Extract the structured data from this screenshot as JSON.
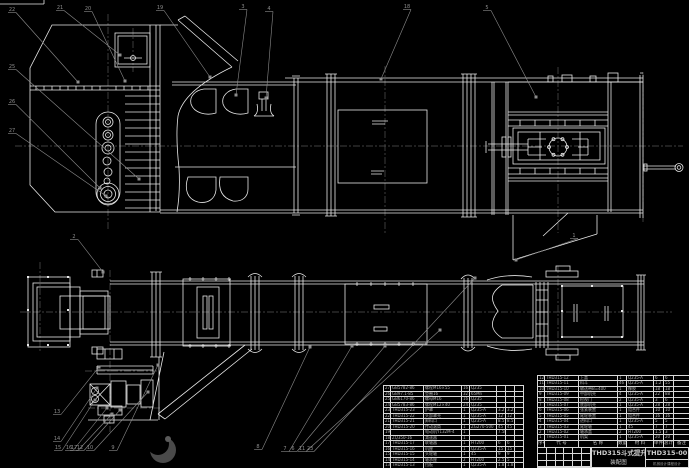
{
  "drawing": {
    "title": "THD315斗式提升机",
    "subtitle": "装配图",
    "drawing_number": "THD315-00",
    "footer_note": "机械设计课程设计",
    "views": {
      "upper_view": "侧视图 (head / casing / boot section)",
      "lower_view": "俯视图 (plan view with drive unit)"
    },
    "colors": {
      "background": "#000000",
      "line": "#e8e8e8",
      "leader": "#8c8c8c",
      "centerline": "#565656",
      "table_text": "#b0b0b0",
      "table_line": "#d9d9d9",
      "stamp": "#4a4a4a"
    }
  },
  "bom_header": [
    [
      "序号",
      "代 号",
      "名 称",
      "数量",
      "材 料",
      "单件",
      "总计",
      "备注"
    ]
  ],
  "bom_left": {
    "rows": [
      [
        "27",
        "GB5782-86",
        "螺栓M16×55",
        "16",
        "Q235",
        "",
        "",
        ""
      ],
      [
        "26",
        "GB97.1-85",
        "垫圈16",
        "32",
        "65Mn",
        "",
        "",
        ""
      ],
      [
        "25",
        "GB6170-86",
        "螺母M16",
        "16",
        "Q235",
        "",
        "",
        ""
      ],
      [
        "24",
        "GB5783-86",
        "螺栓M12×40",
        "24",
        "Q235",
        "",
        "",
        ""
      ],
      [
        "23",
        "THD315-23",
        "护罩",
        "1",
        "Q235-A",
        "3.2",
        "3.2",
        ""
      ],
      [
        "22",
        "THD315-22",
        "头部罩壳",
        "1",
        "Q235-A",
        "12",
        "12",
        ""
      ],
      [
        "21",
        "THD315-21",
        "卸料口",
        "1",
        "Q235-A",
        "8.5",
        "8.5",
        ""
      ],
      [
        "20",
        "THD315-20",
        "传动滚筒",
        "1",
        "ZG270-500",
        "45",
        "45",
        ""
      ],
      [
        "19",
        "",
        "电动机Y132M-4",
        "1",
        "",
        "7.5kW",
        "",
        ""
      ],
      [
        "18",
        "ZQ350-16",
        "减速器",
        "1",
        "",
        "",
        "",
        ""
      ],
      [
        "17",
        "THD315-17",
        "联轴器",
        "1",
        "HT200",
        "6",
        "6",
        ""
      ],
      [
        "16",
        "THD315-16",
        "机座",
        "1",
        "Q235-A",
        "15",
        "15",
        ""
      ],
      [
        "15",
        "THD315-15",
        "头轮轴",
        "1",
        "45",
        "9",
        "9",
        ""
      ],
      [
        "14",
        "THD315-14",
        "轴承座",
        "2",
        "HT200",
        "2.5",
        "5",
        ""
      ],
      [
        "13",
        "THD315-13",
        "挡板",
        "1",
        "Q235-A",
        "1.8",
        "1.8",
        ""
      ]
    ]
  },
  "bom_right": {
    "rows": [
      [
        "12",
        "THD315-12",
        "上盖",
        "1",
        "Q235-A",
        "6",
        "6",
        ""
      ],
      [
        "11",
        "THD315-11",
        "料斗",
        "46",
        "Q235-A",
        "1.2",
        "55",
        ""
      ],
      [
        "10",
        "THD315-10",
        "输送带B=400",
        "1",
        "橡胶",
        "18",
        "18",
        ""
      ],
      [
        "9",
        "THD315-09",
        "中部机壳",
        "4",
        "Q235-A",
        "22",
        "88",
        ""
      ],
      [
        "8",
        "THD315-08",
        "检视门",
        "2",
        "Q235-A",
        "3",
        "6",
        ""
      ],
      [
        "7",
        "THD315-07",
        "底部机壳",
        "1",
        "Q235-A",
        "28",
        "28",
        ""
      ],
      [
        "6",
        "THD315-06",
        "张紧装置",
        "1",
        "组合件",
        "10",
        "10",
        ""
      ],
      [
        "5",
        "THD315-05",
        "尾轮装置",
        "1",
        "组合件",
        "16",
        "16",
        ""
      ],
      [
        "4",
        "THD315-04",
        "进料口",
        "1",
        "Q235-A",
        "5",
        "5",
        ""
      ],
      [
        "3",
        "THD315-03",
        "尾轮轴",
        "1",
        "45",
        "7",
        "7",
        ""
      ],
      [
        "2",
        "THD315-02",
        "轴承盖",
        "2",
        "HT200",
        "1.5",
        "3",
        ""
      ],
      [
        "1",
        "THD315-01",
        "机架",
        "1",
        "Q235-A",
        "20",
        "20",
        ""
      ]
    ]
  },
  "balloons": {
    "upper": [
      {
        "label": "22",
        "x": 12,
        "y": 11,
        "tx": 78,
        "ty": 82
      },
      {
        "label": "21",
        "x": 60,
        "y": 9,
        "tx": 120,
        "ty": 55
      },
      {
        "label": "20",
        "x": 88,
        "y": 10,
        "tx": 125,
        "ty": 81
      },
      {
        "label": "19",
        "x": 160,
        "y": 9,
        "tx": 210,
        "ty": 77
      },
      {
        "label": "3",
        "x": 243,
        "y": 8,
        "tx": 236,
        "ty": 95
      },
      {
        "label": "4",
        "x": 269,
        "y": 10,
        "tx": 266,
        "ty": 98
      },
      {
        "label": "18",
        "x": 407,
        "y": 8,
        "tx": 381,
        "ty": 79
      },
      {
        "label": "5",
        "x": 487,
        "y": 9,
        "tx": 536,
        "ty": 97
      },
      {
        "label": "25",
        "x": 12,
        "y": 68,
        "tx": 139,
        "ty": 179
      },
      {
        "label": "26",
        "x": 12,
        "y": 103,
        "tx": 100,
        "ty": 188
      },
      {
        "label": "27",
        "x": 12,
        "y": 132,
        "tx": 106,
        "ty": 196
      }
    ],
    "lower": [
      {
        "label": "2",
        "x": 74,
        "y": 238,
        "tx": 103,
        "ty": 272
      },
      {
        "label": "1",
        "x": 574,
        "y": 237,
        "tx": 516,
        "ty": 260
      },
      {
        "label": "13",
        "x": 57,
        "y": 413,
        "tx": 99,
        "ty": 367
      },
      {
        "label": "14",
        "x": 57,
        "y": 440,
        "tx": 97,
        "ty": 388
      },
      {
        "label": "15",
        "x": 58,
        "y": 449,
        "tx": 95,
        "ty": 400
      },
      {
        "label": "16",
        "x": 69,
        "y": 449,
        "tx": 107,
        "ty": 408
      },
      {
        "label": "17",
        "x": 74,
        "y": 449,
        "tx": 112,
        "ty": 414
      },
      {
        "label": "12",
        "x": 80,
        "y": 449,
        "tx": 120,
        "ty": 410
      },
      {
        "label": "10",
        "x": 90,
        "y": 449,
        "tx": 148,
        "ty": 392
      },
      {
        "label": "9",
        "x": 113,
        "y": 449,
        "tx": 158,
        "ty": 365
      },
      {
        "label": "8",
        "x": 258,
        "y": 448,
        "tx": 310,
        "ty": 347
      },
      {
        "label": "7",
        "x": 285,
        "y": 450,
        "tx": 352,
        "ty": 346
      },
      {
        "label": "6",
        "x": 293,
        "y": 450,
        "tx": 385,
        "ty": 346
      },
      {
        "label": "11",
        "x": 302,
        "y": 450,
        "tx": 440,
        "ty": 330
      },
      {
        "label": "23",
        "x": 310,
        "y": 450,
        "tx": 475,
        "ty": 278
      }
    ]
  }
}
